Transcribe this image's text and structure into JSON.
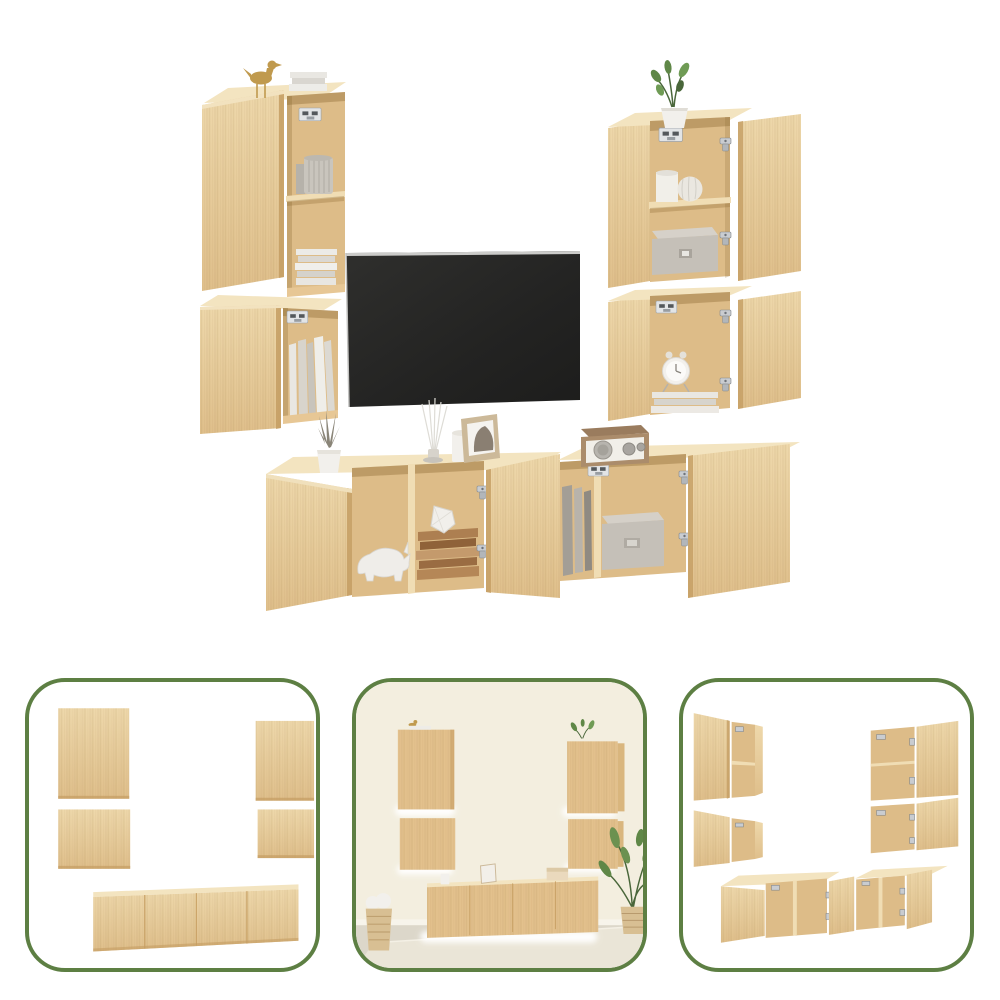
{
  "page": {
    "background": "#ffffff"
  },
  "palette": {
    "accent_green": "#5d7f43",
    "wood_face": "#e7c795",
    "wood_face_light": "#f0ddb4",
    "wood_top": "#f3e4c0",
    "wood_side": "#c49d63",
    "wood_interior": "#ddbc88",
    "tv_screen": "#262625",
    "tv_bezel": "#cbcbc9",
    "metal": "#c9ccd0",
    "white_decor": "#f2f0ec",
    "gray_decor": "#c4bfb7",
    "gray_decor_dark": "#a29d95",
    "book_brown": "#a87c4f",
    "gold": "#c09a4e",
    "plant_green": "#5f8747",
    "plant_green_dark": "#49663a",
    "frame_tan": "#ccb999",
    "radio_tan": "#ab8c6b",
    "wall_cream": "#f3eedf",
    "floor_beige": "#dcd7ca",
    "rug_beige": "#eae5d7",
    "basket_tan": "#d8bf93"
  },
  "main_image": {
    "name": "six-piece-tv-wall-unit-sonoma-oak",
    "pieces": [
      "tall-wall-cabinet-left",
      "small-wall-cabinet-left",
      "tv-screen",
      "tall-wall-cabinet-right",
      "small-wall-cabinet-right",
      "tv-stand-cabinet-left",
      "tv-stand-cabinet-right"
    ],
    "decor": [
      "gold-bird-figurine",
      "stacked-books",
      "pleated-vase",
      "potted-plant",
      "white-vases",
      "gray-storage-box",
      "alarm-clock",
      "cactus-pot",
      "incense-sticks",
      "candle",
      "picture-frame",
      "retro-radio",
      "rhino-figurine",
      "geometric-ornament",
      "wall-mount-brackets",
      "door-hinges"
    ]
  },
  "thumbnails": [
    {
      "name": "closed-front-view"
    },
    {
      "name": "room-scene-view"
    },
    {
      "name": "open-doors-view"
    }
  ]
}
